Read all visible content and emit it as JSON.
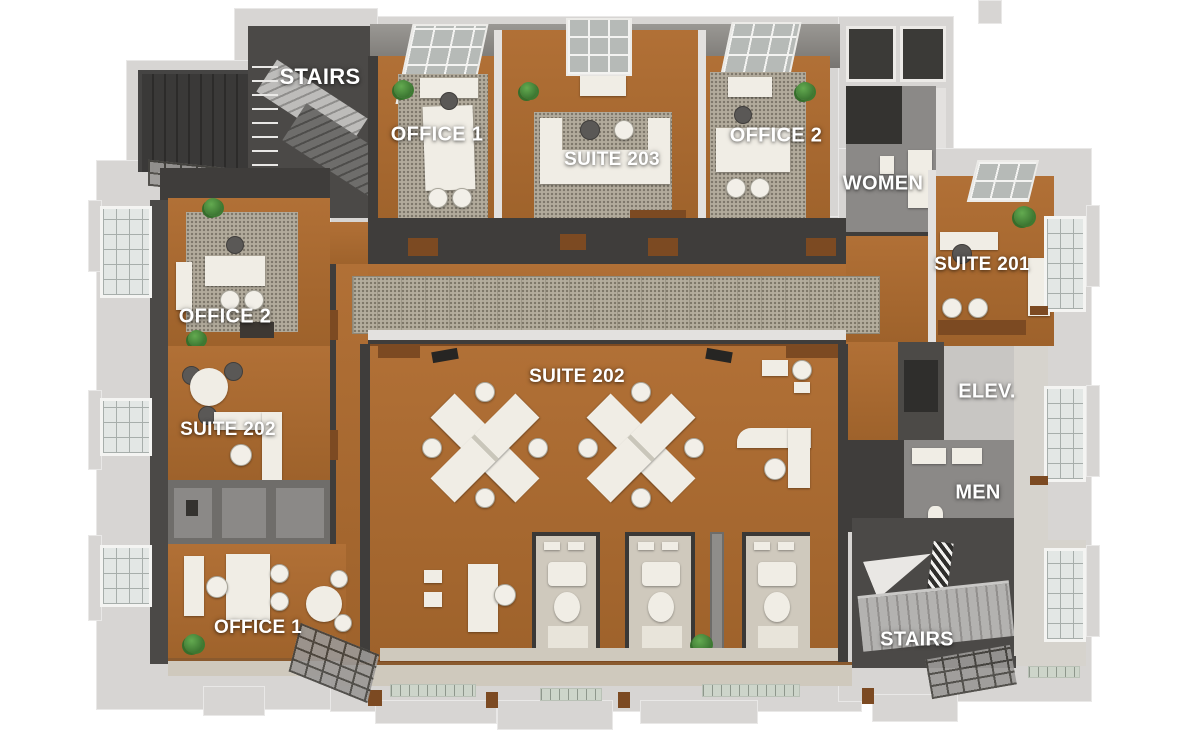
{
  "title": "3D rendered second-floor office floor plan",
  "rooms": [
    {
      "id": "stairs-top",
      "label": "STAIRS"
    },
    {
      "id": "office1-top",
      "label": "OFFICE 1"
    },
    {
      "id": "suite-203",
      "label": "SUITE 203"
    },
    {
      "id": "office2-top",
      "label": "OFFICE 2"
    },
    {
      "id": "women",
      "label": "WOMEN"
    },
    {
      "id": "suite-201",
      "label": "SUITE 201"
    },
    {
      "id": "office2-left",
      "label": "OFFICE 2"
    },
    {
      "id": "suite-202-left",
      "label": "SUITE 202"
    },
    {
      "id": "elevator",
      "label": "ELEV."
    },
    {
      "id": "suite-202-main",
      "label": "SUITE 202"
    },
    {
      "id": "men",
      "label": "MEN"
    },
    {
      "id": "office1-left",
      "label": "OFFICE 1"
    },
    {
      "id": "stairs-bottom",
      "label": "STAIRS"
    }
  ],
  "colors": {
    "background": "#ffffff",
    "outer_wall": "#d7d5d3",
    "dark_wall": "#3f3d3b",
    "wood_floor": "#a8682f",
    "wood_trim": "#7c4a22",
    "carpet": "#b4ad9d",
    "gray_floor": "#8b8987",
    "tan_floor": "#cfc9bd",
    "furniture": "#f0ede5",
    "plant_green": "#3c7a31",
    "window_glass": "#e3e7e5",
    "label_text": "#ffffff"
  }
}
